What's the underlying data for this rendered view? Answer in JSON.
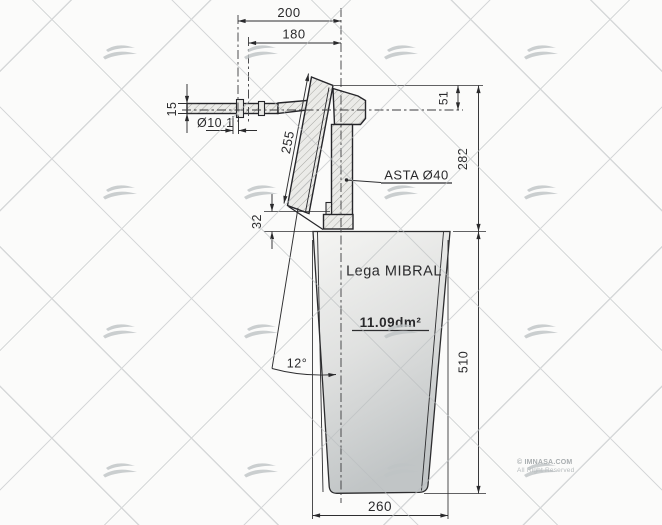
{
  "dimensions": {
    "width_200": "200",
    "width_180": "180",
    "tiller_thickness": "15",
    "hole_diameter": "Ø10.1",
    "plate_length": "255",
    "head_offset": "51",
    "shaft_label": "ASTA Ø40",
    "head_height": "282",
    "step_32": "32",
    "rake_angle": "12°",
    "blade_height": "510",
    "blade_width": "260"
  },
  "labels": {
    "material": "Lega MIBRAL",
    "area": "11.09dm²"
  },
  "watermark": {
    "copyright": "© IMNASA.COM",
    "rights": "All Right Reserved",
    "logo_icon": "double-wave-icon"
  },
  "colors": {
    "ink": "#2a2a2c",
    "paper": "#fbfbfa",
    "watermark_gray": "#bfc3c5",
    "blade_light": "#f5f5f3",
    "blade_dark": "#c1c5c6"
  }
}
